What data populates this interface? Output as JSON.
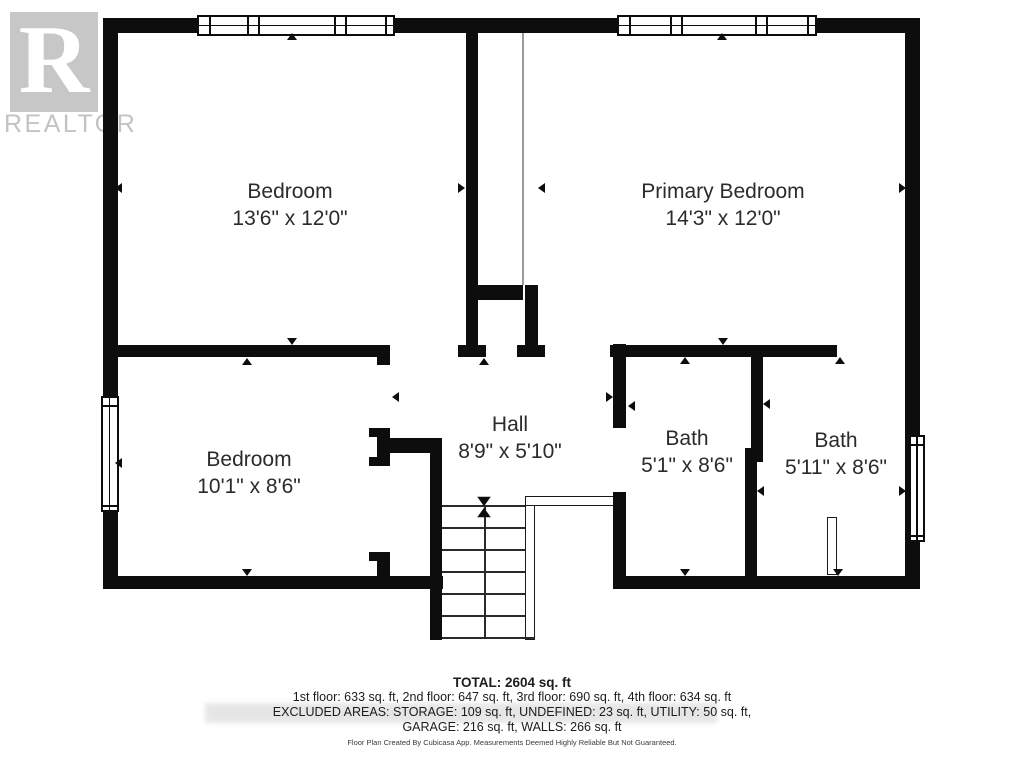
{
  "watermark": {
    "letter": "R",
    "brand": "REALTOR",
    "registered": "®"
  },
  "rooms": [
    {
      "name": "Bedroom",
      "dims": "13'6\" x 12'0\"",
      "cx": 290,
      "cy": 205
    },
    {
      "name": "Primary Bedroom",
      "dims": "14'3\" x 12'0\"",
      "cx": 723,
      "cy": 205
    },
    {
      "name": "Bedroom",
      "dims": "10'1\" x 8'6\"",
      "cx": 249,
      "cy": 473
    },
    {
      "name": "Hall",
      "dims": "8'9\" x 5'10\"",
      "cx": 510,
      "cy": 438
    },
    {
      "name": "Bath",
      "dims": "5'1\" x 8'6\"",
      "cx": 687,
      "cy": 452
    },
    {
      "name": "Bath",
      "dims": "5'11\" x 8'6\"",
      "cx": 836,
      "cy": 454
    }
  ],
  "summary": {
    "total": "TOTAL: 2604 sq. ft",
    "floors": "1st floor: 633 sq. ft, 2nd floor: 647 sq. ft, 3rd floor: 690 sq. ft, 4th floor: 634 sq. ft",
    "excluded": "EXCLUDED AREAS: STORAGE: 109 sq. ft, UNDEFINED: 23 sq. ft, UTILITY: 50 sq. ft,",
    "garage": "GARAGE: 216 sq. ft, WALLS: 266 sq. ft",
    "disclaimer": "Floor Plan Created By Cubicasa App. Measurements Deemed Highly Reliable But Not Guaranteed."
  },
  "colors": {
    "wall": "#0d0d0d",
    "text": "#2b2b2b",
    "watermark": "#c7c7c7",
    "divider": "#9a9a9a"
  },
  "plan": {
    "walls": [
      [
        103,
        18,
        817,
        15
      ],
      [
        103,
        18,
        15,
        570
      ],
      [
        905,
        18,
        15,
        570
      ],
      [
        103,
        576,
        340,
        13
      ],
      [
        613,
        576,
        307,
        13
      ],
      [
        103,
        345,
        287,
        12
      ],
      [
        377,
        345,
        13,
        20
      ],
      [
        466,
        33,
        12,
        312
      ],
      [
        458,
        345,
        28,
        12
      ],
      [
        472,
        285,
        51,
        15
      ],
      [
        525,
        285,
        13,
        60
      ],
      [
        517,
        345,
        28,
        12
      ],
      [
        610,
        345,
        227,
        12
      ],
      [
        377,
        428,
        13,
        38
      ],
      [
        369,
        428,
        9,
        9
      ],
      [
        369,
        457,
        9,
        9
      ],
      [
        388,
        438,
        54,
        15
      ],
      [
        430,
        438,
        12,
        202
      ],
      [
        369,
        552,
        9,
        9
      ],
      [
        377,
        552,
        13,
        24
      ],
      [
        613,
        344,
        13,
        84
      ],
      [
        613,
        492,
        13,
        96
      ],
      [
        751,
        345,
        12,
        109
      ],
      [
        745,
        448,
        18,
        14
      ],
      [
        745,
        452,
        12,
        124
      ]
    ],
    "caps": [
      [
        103,
        389,
        14,
        8
      ],
      [
        103,
        510,
        14,
        8
      ]
    ],
    "windows": [
      {
        "x": 197,
        "y": 15,
        "w": 198,
        "h": 21,
        "orient": "h",
        "divs": [
          10,
          48,
          59,
          135,
          146,
          186
        ]
      },
      {
        "x": 617,
        "y": 15,
        "w": 200,
        "h": 21,
        "orient": "h",
        "divs": [
          10,
          51,
          62,
          136,
          147,
          188
        ]
      },
      {
        "x": 101,
        "y": 396,
        "w": 18,
        "h": 116,
        "orient": "v",
        "divs": [
          7,
          107
        ]
      },
      {
        "x": 909,
        "y": 435,
        "w": 16,
        "h": 107,
        "orient": "v",
        "divs": [
          7,
          98
        ]
      }
    ],
    "thin_lines": [
      [
        522,
        33,
        2,
        252
      ]
    ],
    "rails": [
      [
        525,
        496,
        10,
        144
      ],
      [
        525,
        496,
        93,
        10
      ]
    ],
    "door_leaf": [
      827,
      517,
      10,
      58
    ],
    "stairs": {
      "left": 442,
      "top": 505,
      "right": 525,
      "railRight": 535,
      "bottom": 637,
      "center": 484,
      "treads": [
        505,
        527,
        549,
        571,
        593,
        615,
        637
      ]
    },
    "markers": [
      [
        292,
        36,
        "u"
      ],
      [
        722,
        36,
        "u"
      ],
      [
        118,
        188,
        "l"
      ],
      [
        461,
        188,
        "r"
      ],
      [
        541,
        188,
        "l"
      ],
      [
        902,
        188,
        "r"
      ],
      [
        247,
        361,
        "u"
      ],
      [
        292,
        341,
        "d"
      ],
      [
        395,
        397,
        "l"
      ],
      [
        484,
        361,
        "u"
      ],
      [
        609,
        397,
        "r"
      ],
      [
        631,
        406,
        "l"
      ],
      [
        685,
        360,
        "u"
      ],
      [
        723,
        341,
        "d"
      ],
      [
        840,
        360,
        "u"
      ],
      [
        766,
        404,
        "l"
      ],
      [
        760,
        491,
        "l"
      ],
      [
        902,
        491,
        "r"
      ],
      [
        247,
        572,
        "d"
      ],
      [
        685,
        572,
        "d"
      ],
      [
        838,
        572,
        "d"
      ],
      [
        118,
        463,
        "l"
      ],
      [
        484,
        501,
        "d",
        "big"
      ],
      [
        484,
        512,
        "u",
        "big"
      ]
    ]
  }
}
